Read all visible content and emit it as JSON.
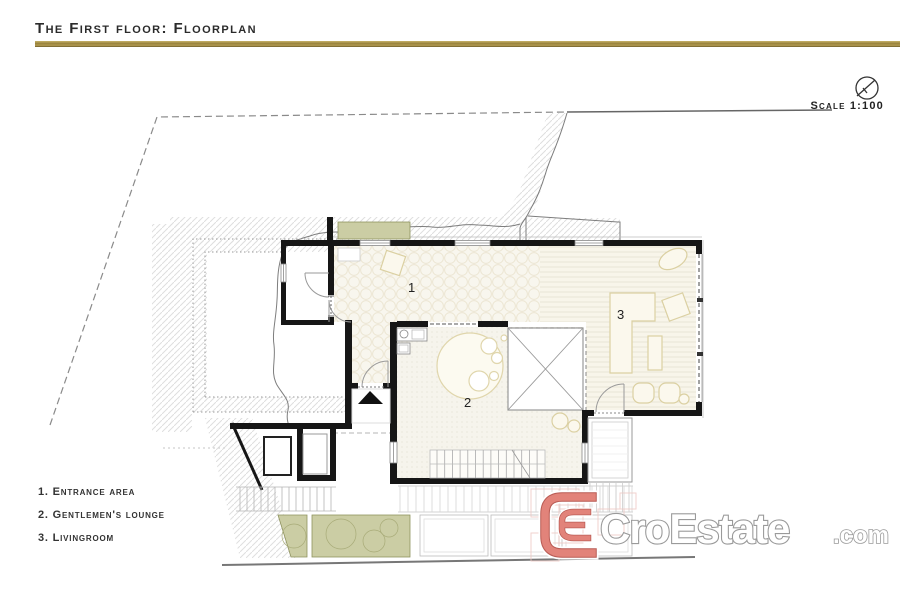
{
  "header": {
    "title": "The First floor: Floorplan"
  },
  "scale": {
    "label": "Scale 1:100"
  },
  "legend": {
    "items": [
      {
        "text": "1. Entrance area"
      },
      {
        "text": "2. Gentlemen's lounge"
      },
      {
        "text": "3. Livingroom"
      }
    ]
  },
  "rooms": {
    "r1": "1",
    "r2": "2",
    "r3": "3"
  },
  "watermark": {
    "brand": "CroEstate",
    "tld": ".com"
  },
  "colors": {
    "accent_gold": "#96803a",
    "planter_green": "#cbcda4",
    "logo_red": "#e2837a",
    "wall_black": "#161616"
  }
}
